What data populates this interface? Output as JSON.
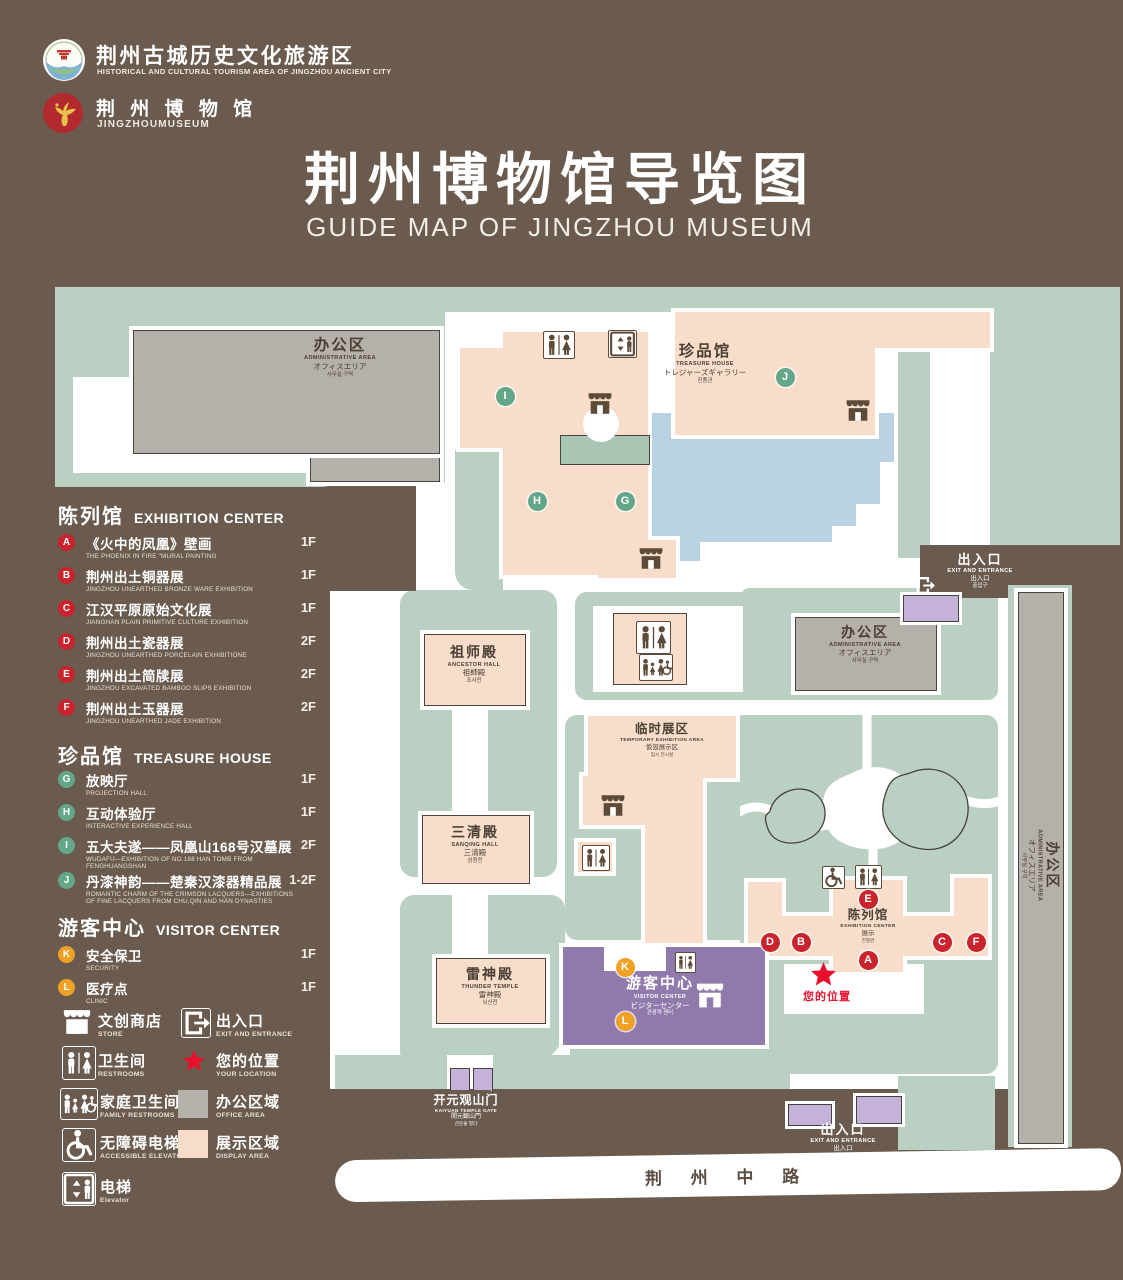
{
  "header": {
    "logo1": {
      "line1": "荆州古城历史文化旅游区",
      "line2": "HISTORICAL AND CULTURAL TOURISM AREA OF JINGZHOU ANCIENT CITY"
    },
    "logo2": {
      "line1": "荆 州 博 物 馆",
      "line2": "JINGZHOUMUSEUM"
    },
    "title_zh": "荆州博物馆导览图",
    "title_en": "GUIDE MAP OF JINGZHOU MUSEUM"
  },
  "legend": {
    "exhibition": {
      "zh": "陈列馆",
      "en": "EXHIBITION CENTER",
      "items": [
        {
          "id": "A",
          "zh": "《火中的凤凰》壁画",
          "en": "THE PHOENIX IN FIRE \"MURAL PAINTING",
          "floor": "1F"
        },
        {
          "id": "B",
          "zh": "荆州出土铜器展",
          "en": "JINGZHOU UNEARTHED BRONZE WARE EXHIBITION",
          "floor": "1F"
        },
        {
          "id": "C",
          "zh": "江汉平原原始文化展",
          "en": "JIANGHAN PLAIN PRIMITIVE CULTURE EXHIBITION",
          "floor": "1F"
        },
        {
          "id": "D",
          "zh": "荆州出土瓷器展",
          "en": "JINGZHOU UNEARTHED PORCELAIN EXHIBITIONE",
          "floor": "2F"
        },
        {
          "id": "E",
          "zh": "荆州出土简牍展",
          "en": "JINGZHOU EXCAVATED BAMBOO SLIPS EXHIBITION",
          "floor": "2F"
        },
        {
          "id": "F",
          "zh": "荆州出土玉器展",
          "en": "JINGZHOU UNEARTHED JADE EXHIBITION",
          "floor": "2F"
        }
      ]
    },
    "treasure": {
      "zh": "珍品馆",
      "en": "TREASURE HOUSE",
      "items": [
        {
          "id": "G",
          "zh": "放映厅",
          "en": "PROJECTION HALL",
          "floor": "1F"
        },
        {
          "id": "H",
          "zh": "互动体验厅",
          "en": "INTERACTIVE EXPERIENCE HALL",
          "floor": "1F"
        },
        {
          "id": "I",
          "zh": "五大夫遂——凤凰山168号汉墓展",
          "en": "WUDAFU—EXHIBITION OF NO.168 HAN TOMB FROM FENGHUANGSHAN",
          "floor": "2F"
        },
        {
          "id": "J",
          "zh": "丹漆神韵——楚秦汉漆器精品展",
          "en": "ROMANTIC CHARM OF THE CRIMSON LACQUERS—EXHIBITIONS OF FINE LACQUERS FROM CHU,QIN AND HAN DYNASTIES",
          "floor": "1-2F"
        }
      ]
    },
    "visitor": {
      "zh": "游客中心",
      "en": "VISITOR CENTER",
      "items": [
        {
          "id": "K",
          "zh": "安全保卫",
          "en": "SECURITY",
          "floor": "1F"
        },
        {
          "id": "L",
          "zh": "医疗点",
          "en": "CLINIC",
          "floor": "1F"
        }
      ]
    },
    "facilities_left": [
      {
        "icon": "store",
        "zh": "文创商店",
        "en": "STORE"
      },
      {
        "icon": "restroom",
        "zh": "卫生间",
        "en": "RESTROOMS"
      },
      {
        "icon": "family-restroom",
        "zh": "家庭卫生间",
        "en": "FAMILY RESTROOMS"
      },
      {
        "icon": "accessible-elevator",
        "zh": "无障碍电梯",
        "en": "ACCESSIBLE ELEVATOR"
      },
      {
        "icon": "elevator",
        "zh": "电梯",
        "en": "Elevator"
      }
    ],
    "facilities_right": [
      {
        "icon": "exit",
        "zh": "出入口",
        "en": "EXIT AND ENTRANCE"
      },
      {
        "icon": "location-star",
        "zh": "您的位置",
        "en": "YOUR LOCATION"
      },
      {
        "icon": "office-swatch",
        "zh": "办公区域",
        "en": "OFFICE AREA"
      },
      {
        "icon": "display-swatch",
        "zh": "展示区域",
        "en": "DISPLAY AREA"
      }
    ]
  },
  "map": {
    "buildings": {
      "admin_topleft": {
        "l1": "办公区",
        "l2": "ADMINISTRATIVE AREA",
        "l3": "オフィスエリア",
        "l4": "사무실 구역"
      },
      "treasure": {
        "l1": "珍品馆",
        "l2": "TREASURE HOUSE",
        "l3": "トレジャーズギャラリー",
        "l4": "진품관"
      },
      "ancestor": {
        "l1": "祖师殿",
        "l2": "ANCESTOR HALL",
        "l3": "祖師殿",
        "l4": "조사전"
      },
      "sanqing": {
        "l1": "三清殿",
        "l2": "SANQING HALL",
        "l3": "三清殿",
        "l4": "삼청전"
      },
      "thunder": {
        "l1": "雷神殿",
        "l2": "THUNDER TEMPLE",
        "l3": "雷神殿",
        "l4": "뇌신전"
      },
      "temporary": {
        "l1": "临时展区",
        "l2": "TEMPORARY EXHIBITION AREA",
        "l3": "仮設展示区",
        "l4": "임시 전시실"
      },
      "admin_right": {
        "l1": "办公区",
        "l2": "ADMINISTRATIVE AREA",
        "l3": "オフィスエリア",
        "l4": "사무실 구역"
      },
      "admin_strip": {
        "l1": "办公区",
        "l2": "ADMINISTRATIVE AREA",
        "l3": "オフィスエリア",
        "l4": "사무실 구역"
      },
      "exhibition": {
        "l1": "陈列馆",
        "l2": "EXHIBITION CENTER",
        "l3": "展示",
        "l4": "진열관"
      },
      "visitor": {
        "l1": "游客中心",
        "l2": "VISITOR CENTER",
        "l3": "ビジターセンター",
        "l4": "관광객 센터"
      }
    },
    "exit_top": {
      "l1": "出入口",
      "l2": "EXIT AND ENTRANCE",
      "l3": "出入口",
      "l4": "출입구"
    },
    "exit_bottom": {
      "l1": "出入口",
      "l2": "EXIT AND ENTRANCE",
      "l3": "出入口",
      "l4": "출입구"
    },
    "gate": {
      "l1": "开元观山门",
      "l2": "KAIYUAN TEMPLE GATE",
      "l3": "開元観山門",
      "l4": "산문을 열다"
    },
    "road": "荆 州 中 路",
    "your_location": "您的位置",
    "markers": [
      {
        "id": "I",
        "x": 505,
        "y": 396,
        "type": "green"
      },
      {
        "id": "J",
        "x": 785,
        "y": 377,
        "type": "green"
      },
      {
        "id": "H",
        "x": 537,
        "y": 501,
        "type": "green"
      },
      {
        "id": "G",
        "x": 625,
        "y": 501,
        "type": "green"
      },
      {
        "id": "E",
        "x": 868,
        "y": 899,
        "type": "red"
      },
      {
        "id": "D",
        "x": 770,
        "y": 942,
        "type": "red"
      },
      {
        "id": "B",
        "x": 801,
        "y": 942,
        "type": "red"
      },
      {
        "id": "C",
        "x": 942,
        "y": 942,
        "type": "red"
      },
      {
        "id": "F",
        "x": 976,
        "y": 942,
        "type": "red"
      },
      {
        "id": "A",
        "x": 868,
        "y": 960,
        "type": "red"
      },
      {
        "id": "K",
        "x": 625,
        "y": 967,
        "type": "orange"
      },
      {
        "id": "L",
        "x": 625,
        "y": 1021,
        "type": "orange"
      }
    ]
  },
  "colors": {
    "background": "#6a5b4e",
    "courtyard": "#b9d0c2",
    "display_area": "#f8ddcb",
    "office_area": "#b6b0aa",
    "visitor_center": "#8f7aab",
    "pond": "#b8d2e2",
    "marker_red": "#c9232e",
    "marker_green": "#63a788",
    "marker_orange": "#efa126",
    "location_red": "#e8112d"
  }
}
